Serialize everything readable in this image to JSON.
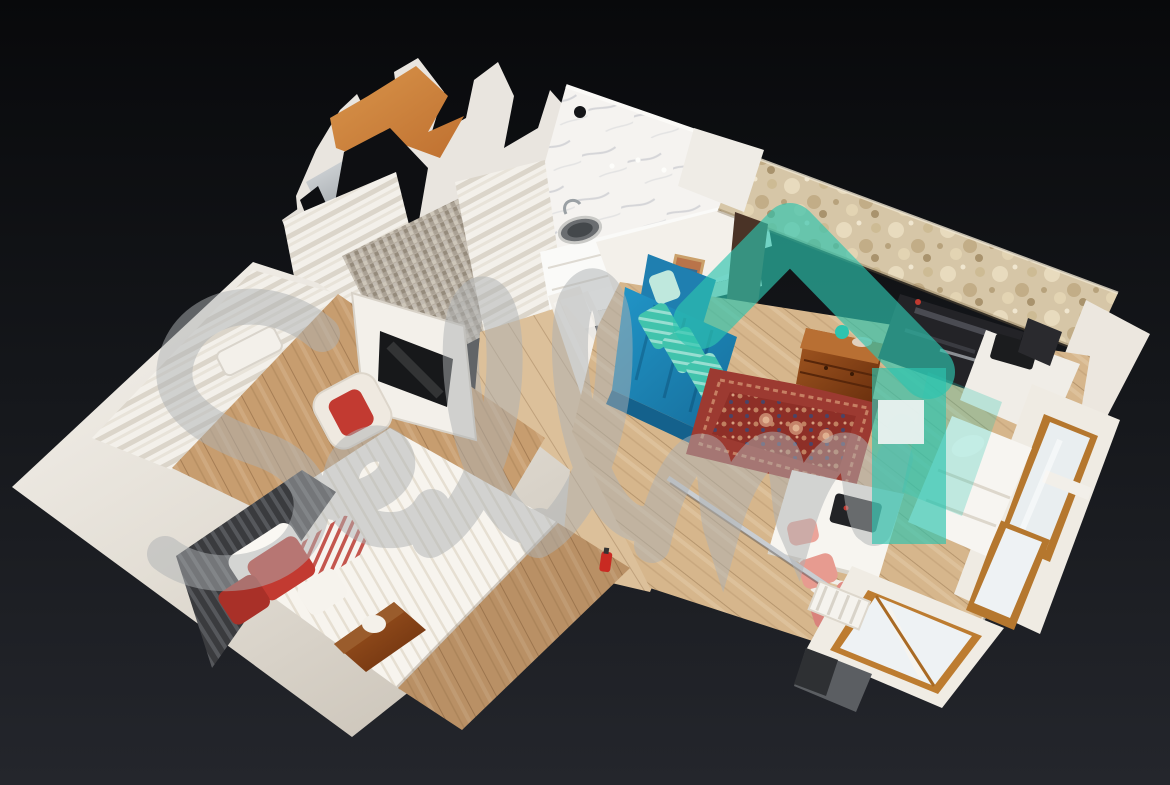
{
  "watermark": {
    "text": "Sellmi",
    "logo": "teal-house-logo"
  },
  "colors": {
    "background_top": "#08090b",
    "background_mid": "#15171b",
    "background_bottom": "#24262c",
    "accent_teal": "#2ec4af",
    "watermark_gray": "#aeb2b4",
    "wall_white": "#f2efe9",
    "stone_wall": "#d6c6a7",
    "wood_floor": "#d6b68c",
    "wood_floor_bedroom": "#c79d6f",
    "sofa_blue": "#2196c8",
    "rug_red": "#9c3a31",
    "pillow_red": "#c23a31",
    "chair_pink": "#e79b90",
    "wood_trim": "#b5772e",
    "mesh_orange": "#d9954b"
  }
}
